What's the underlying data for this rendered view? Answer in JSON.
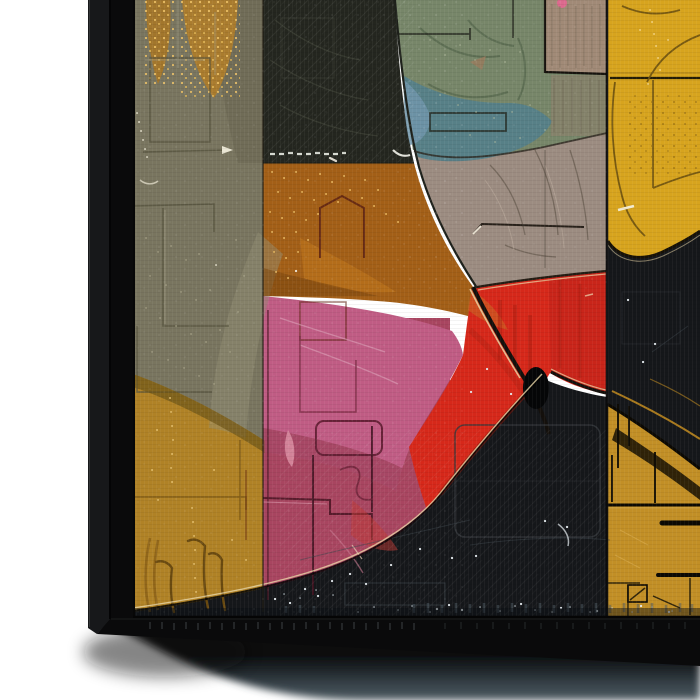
{
  "artwork": {
    "description": "Corner view of a framed abstract geometric canvas painting with etched scratch textures, black floater frame visible on left and bottom edges, soft drop shadow on white background",
    "palette": {
      "background": "#ffffff",
      "frame": "#0a0a0b",
      "frame_side": "#17181a",
      "frame_highlight": "#3c3e40",
      "olive": "#79755f",
      "olive_light": "#949076",
      "gold_left": "#b08226",
      "gold_patch": "#a2762c",
      "charcoal": "#24261f",
      "sage": "#778669",
      "teal": "#55808a",
      "blue_gray": "#7095aa",
      "tan": "#a18a77",
      "taupe": "#9c8c81",
      "copper": "#a35f17",
      "yellow": "#d7a41e",
      "red": "#d6281a",
      "red_deep": "#c8251a",
      "pink": "#c05c84",
      "rose": "#a84560",
      "black_field": "#15171a",
      "gold_br": "#c28f26",
      "navy_band": "#0b0f15",
      "cream_highlight": "#e9d6a6",
      "shadow_gray": "#4d5a61"
    },
    "regions": [
      "olive-field-left",
      "gold-field-lower-left",
      "charcoal-block-top",
      "copper-field",
      "sage-green-arc",
      "teal-patch",
      "tan-block-top",
      "taupe-field",
      "yellow-block-top-right",
      "red-wedge",
      "pink-blob",
      "rose-field",
      "black-field-bottom",
      "gold-block-bottom-right",
      "navy-bottom-band"
    ]
  }
}
